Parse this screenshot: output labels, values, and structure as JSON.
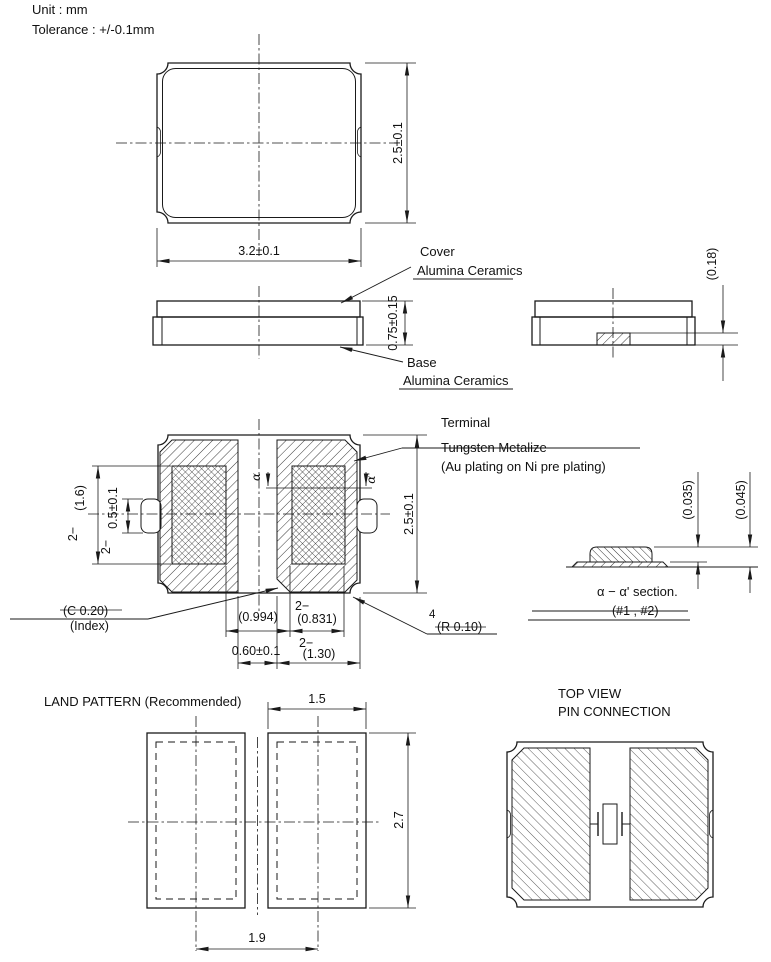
{
  "colors": {
    "line": "#1a1a1a",
    "background": "#ffffff"
  },
  "header": {
    "unit": "Unit : mm",
    "tolerance": "Tolerance : +/-0.1mm"
  },
  "top_view": {
    "width_dim": "3.2±0.1",
    "height_dim": "2.5±0.1"
  },
  "side_view": {
    "height_dim": "0.75±0.15",
    "cover_label": "Cover",
    "cover_material": "Alumina Ceramics",
    "base_label": "Base",
    "base_material": "Alumina Ceramics"
  },
  "end_view": {
    "terminal_thickness_dim": "(0.18)"
  },
  "bottom_view": {
    "height_dim": "2.5±0.1",
    "metallize_height_qty": "2−",
    "metallize_height_dim": "(1.6)",
    "castellation_qty": "2−",
    "castellation_dim": "0.5±0.1",
    "clearance_dim": "(0.994)",
    "metallize_width_qty": "2−",
    "metallize_width_dim": "(0.831)",
    "gap_dim": "0.60±0.1",
    "pad_width_qty": "2−",
    "pad_width_dim": "(1.30)",
    "index_chamfer_dim": "(C 0.20)",
    "index_label": "(Index)",
    "corner_radius_qty": "4",
    "corner_radius_dim": "(R 0.10)",
    "alpha": "α",
    "alpha_prime": "α'",
    "terminal_label": "Terminal",
    "terminal_material": "Tungsten Metalize",
    "terminal_plating": "(Au plating on Ni pre plating)"
  },
  "section_view": {
    "plating_dim": "(0.035)",
    "total_dim": "(0.045)",
    "caption": "α − α' section.",
    "pads_ref": "(#1 , #2)"
  },
  "land_pattern": {
    "title": "LAND PATTERN (Recommended)",
    "pad_width_dim": "1.5",
    "pad_height_dim": "2.7",
    "pitch_dim": "1.9"
  },
  "pin_connection": {
    "title_line1": "TOP VIEW",
    "title_line2": "PIN CONNECTION"
  }
}
